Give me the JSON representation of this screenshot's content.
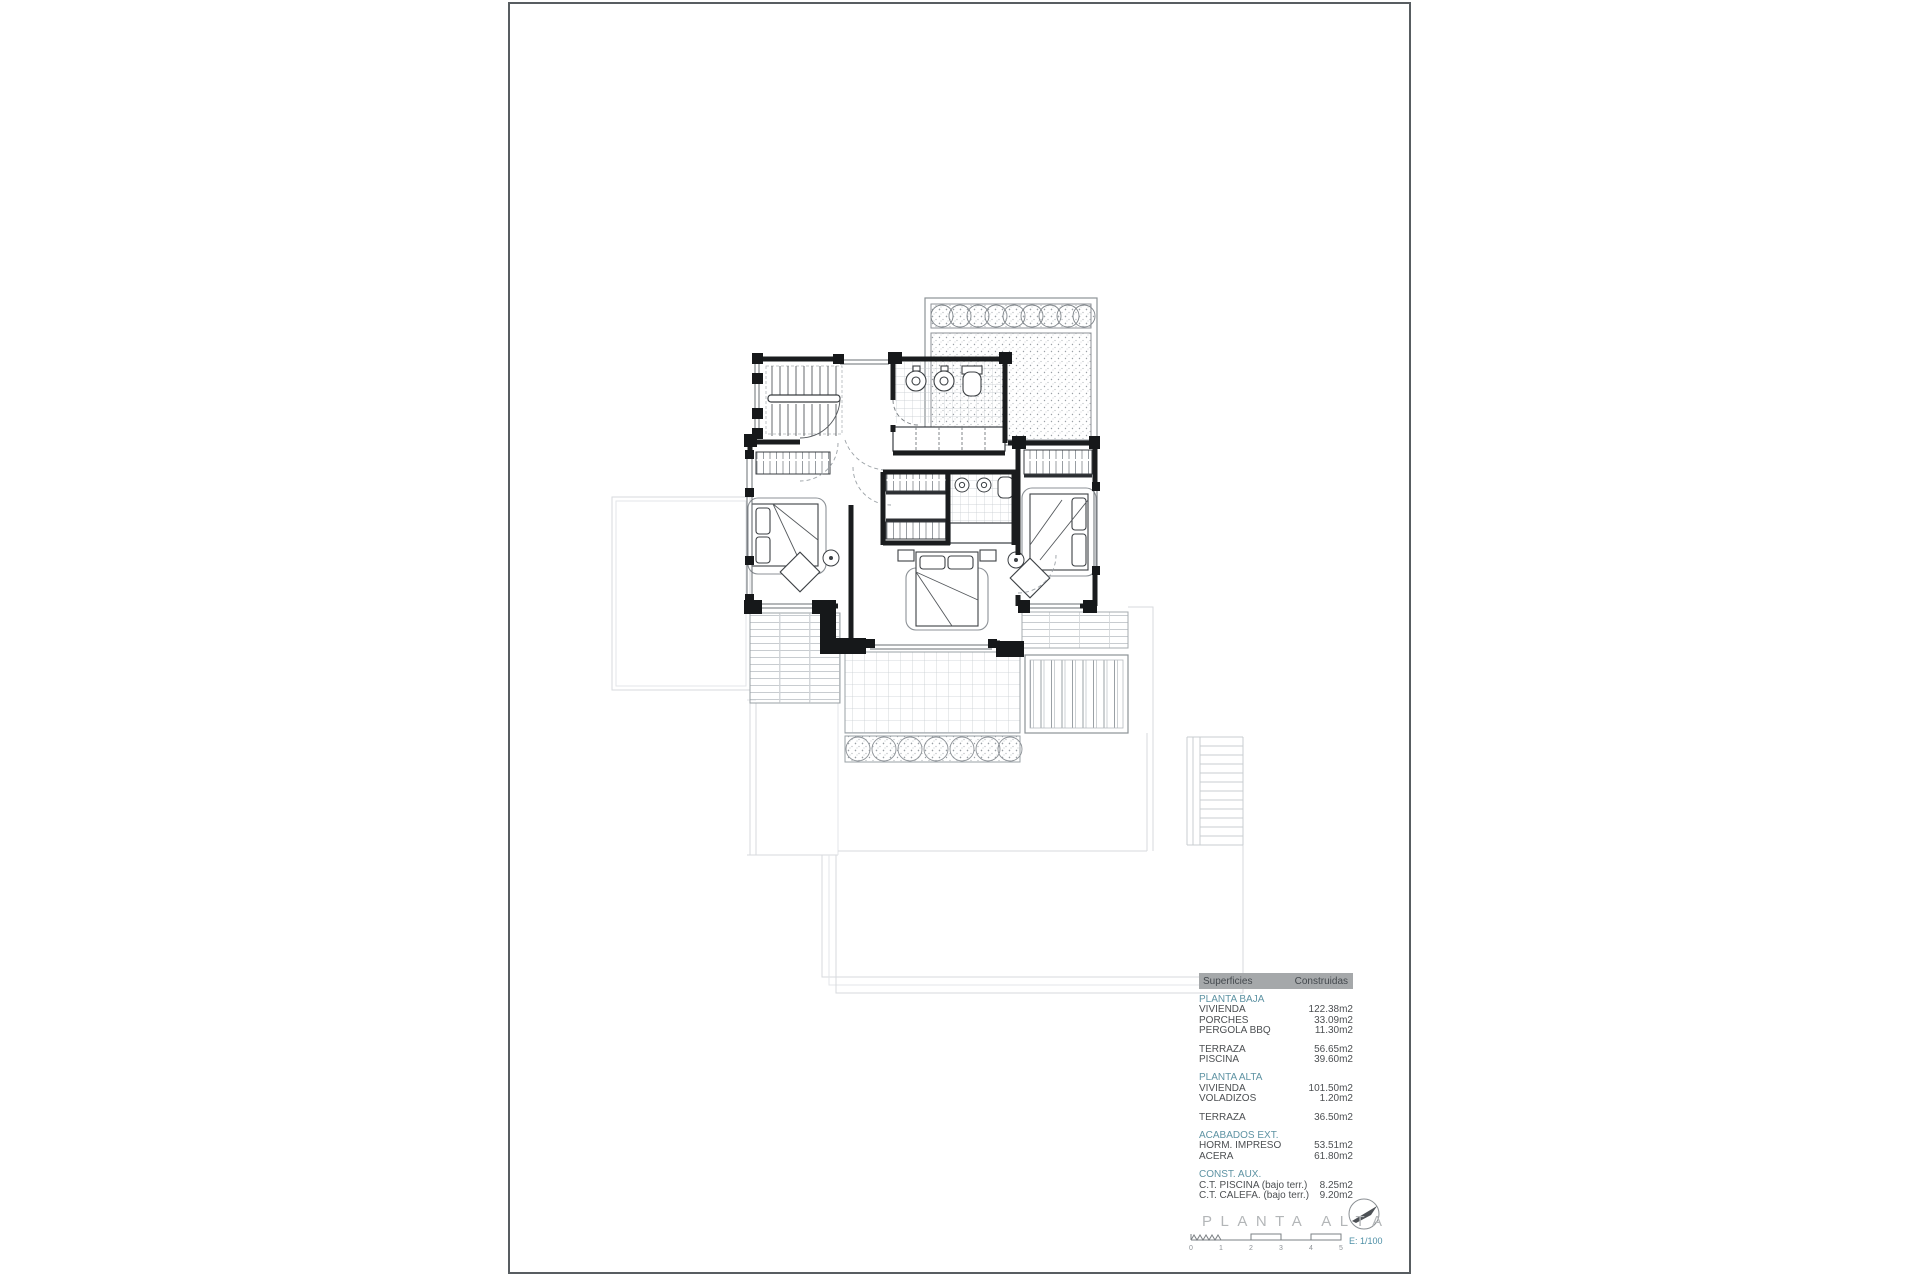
{
  "surfaces_table": {
    "header": {
      "surfaces": "Superficies",
      "built": "Construidas"
    },
    "sections": [
      {
        "title": "PLANTA BAJA",
        "rows": [
          {
            "label": "VIVIENDA",
            "value": "122.38m2"
          },
          {
            "label": "PORCHES",
            "value": "33.09m2"
          },
          {
            "label": "PERGOLA BBQ",
            "value": "11.30m2"
          }
        ]
      },
      {
        "title": null,
        "rows": [
          {
            "label": "TERRAZA",
            "value": "56.65m2"
          },
          {
            "label": "PISCINA",
            "value": "39.60m2"
          }
        ]
      },
      {
        "title": "PLANTA ALTA",
        "rows": [
          {
            "label": "VIVIENDA",
            "value": "101.50m2"
          },
          {
            "label": "VOLADIZOS",
            "value": "1.20m2"
          }
        ]
      },
      {
        "title": null,
        "rows": [
          {
            "label": "TERRAZA",
            "value": "36.50m2"
          }
        ]
      },
      {
        "title": "ACABADOS EXT.",
        "rows": [
          {
            "label": "HORM. IMPRESO",
            "value": "53.51m2"
          },
          {
            "label": "ACERA",
            "value": "61.80m2"
          }
        ]
      },
      {
        "title": "CONST. AUX.",
        "rows": [
          {
            "label": "C.T. PISCINA (bajo terr.)",
            "value": "8.25m2"
          },
          {
            "label": "C.T. CALEFA. (bajo terr.)",
            "value": "9.20m2"
          }
        ]
      }
    ]
  },
  "title_block": {
    "title": "PLANTA ALTA",
    "scale_label": "E: 1/100",
    "scale_ticks": [
      "0",
      "1",
      "2",
      "3",
      "4",
      "5"
    ],
    "north_icon": "compass-north-arrow"
  },
  "colors": {
    "accent_teal": "#5e93a3",
    "table_header_bg": "#a5a8aa",
    "title_gray": "#b3b6b8",
    "wall_black": "#1a1c1e",
    "faint_gray": "#d7dadd"
  }
}
